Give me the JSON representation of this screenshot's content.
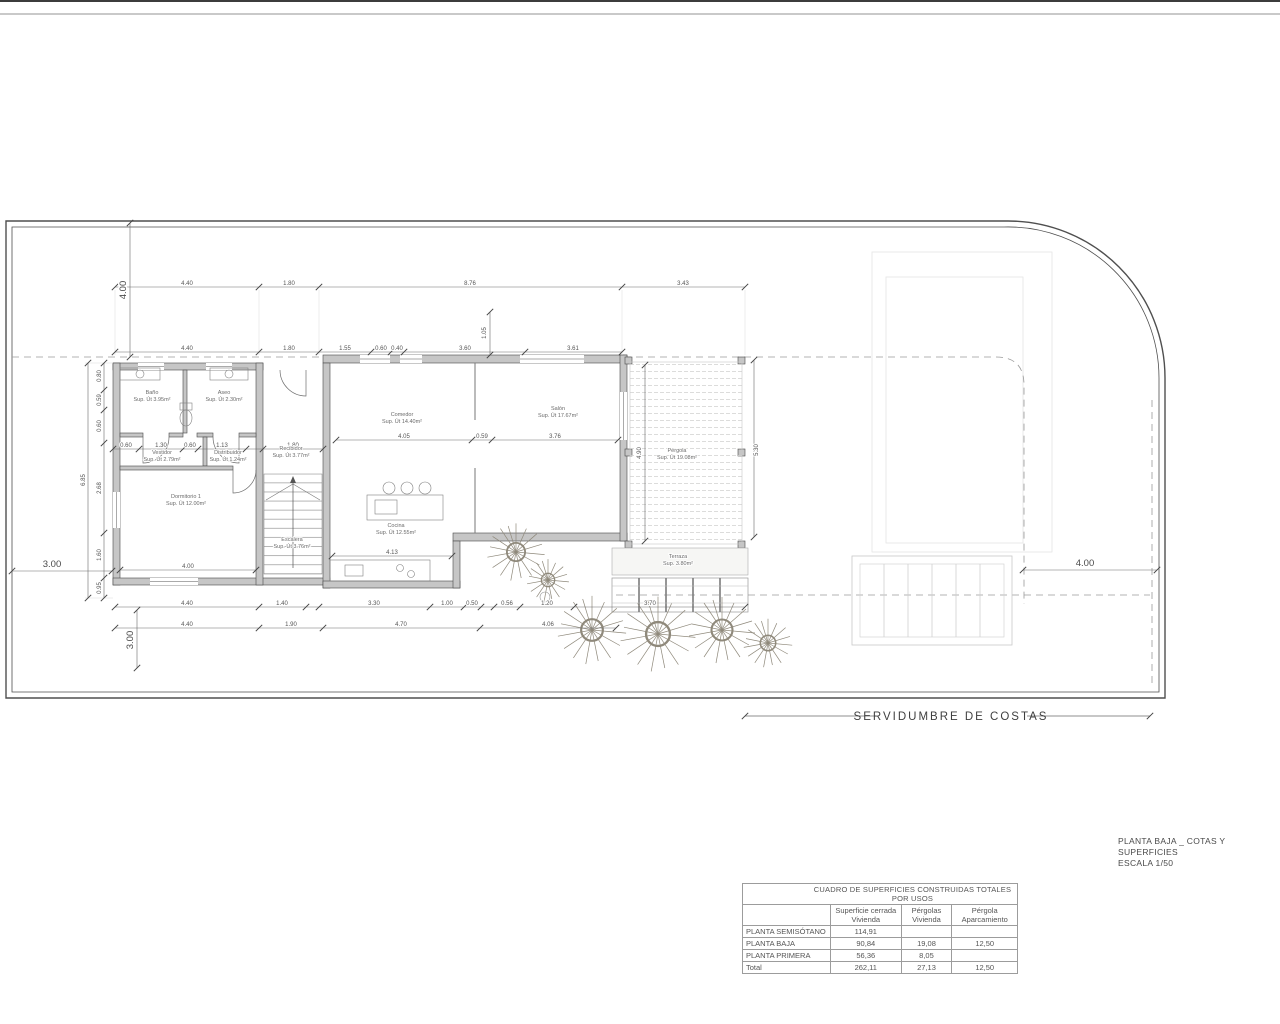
{
  "drawing": {
    "servidumbre": "SERVIDUMBRE DE COSTAS",
    "title_line1": "PLANTA BAJA _ COTAS Y SUPERFICIES",
    "title_line2": "ESCALA 1/50"
  },
  "rooms": {
    "bano": {
      "name": "Baño",
      "area": "Sup. Út 3.95m²"
    },
    "aseo": {
      "name": "Aseo",
      "area": "Sup. Út 2.30m²"
    },
    "vestidor": {
      "name": "Vestidor",
      "area": "Sup. Út 2.79m²"
    },
    "distribuidor": {
      "name": "Distribuidor",
      "area": "Sup. Út 1.24m²"
    },
    "recibidor": {
      "name": "Recibidor",
      "area": "Sup. Út 3.77m²"
    },
    "dormitorio": {
      "name": "Dormitorio 1",
      "area": "Sup. Út 12.00m²"
    },
    "escalera": {
      "name": "Escalera",
      "area": "Sup. Út 3.76m²"
    },
    "comedor": {
      "name": "Comedor",
      "area": "Sup. Út 14.40m²"
    },
    "salon": {
      "name": "Salón",
      "area": "Sup. Út 17.67m²"
    },
    "cocina": {
      "name": "Cocina",
      "area": "Sup. Út 12.55m²"
    },
    "pergola": {
      "name": "Pérgola",
      "area": "Sup. Út 19.08m²"
    },
    "terraza": {
      "name": "Terraza",
      "area": "Sup. 3.80m²"
    }
  },
  "dims": {
    "top_row1": [
      "4.40",
      "1.80",
      "8.76",
      "3.43"
    ],
    "top_left_vertical": "4.00",
    "top_row2": [
      "4.40",
      "1.80",
      "1.55",
      "0.60",
      "0.40",
      "3.60",
      "3.61"
    ],
    "left_column": [
      "0.80",
      "0.59",
      "0.60",
      "2.68",
      "1.60",
      "0.95"
    ],
    "left_total": "6.85",
    "interior_row": [
      "0.60",
      "1.30",
      "0.60",
      "1.13",
      "1.80"
    ],
    "comedor_row": [
      "4.05",
      "0.59",
      "3.76"
    ],
    "dormitorio_width": "4.00",
    "cocina_width": "4.13",
    "window_split": "1.05",
    "pergola_left": "4.90",
    "pergola_right": "5.30",
    "bottom_row1": [
      "4.40",
      "1.40",
      "3.30",
      "1.00",
      "0.50",
      "0.56",
      "1.20",
      "3.70"
    ],
    "bottom_row2": [
      "4.40",
      "1.90",
      "4.70",
      "4.06"
    ],
    "side_left": "3.00",
    "side_right": "4.00",
    "bottom_left_vertical": "3.00"
  },
  "table": {
    "title": "CUADRO DE SUPERFICIES CONSTRUIDAS TOTALES POR USOS",
    "col_headers": [
      "Superficie cerrada\nVivienda",
      "Pérgolas\nVivienda",
      "Pérgola\nAparcamiento"
    ],
    "rows": [
      {
        "label": "PLANTA SEMISÓTANO",
        "c1": "114,91",
        "c2": "",
        "c3": ""
      },
      {
        "label": "PLANTA BAJA",
        "c1": "90,84",
        "c2": "19,08",
        "c3": "12,50"
      },
      {
        "label": "PLANTA PRIMERA",
        "c1": "56,36",
        "c2": "8,05",
        "c3": ""
      },
      {
        "label": "Total",
        "c1": "262,11",
        "c2": "27,13",
        "c3": "12,50"
      }
    ]
  }
}
